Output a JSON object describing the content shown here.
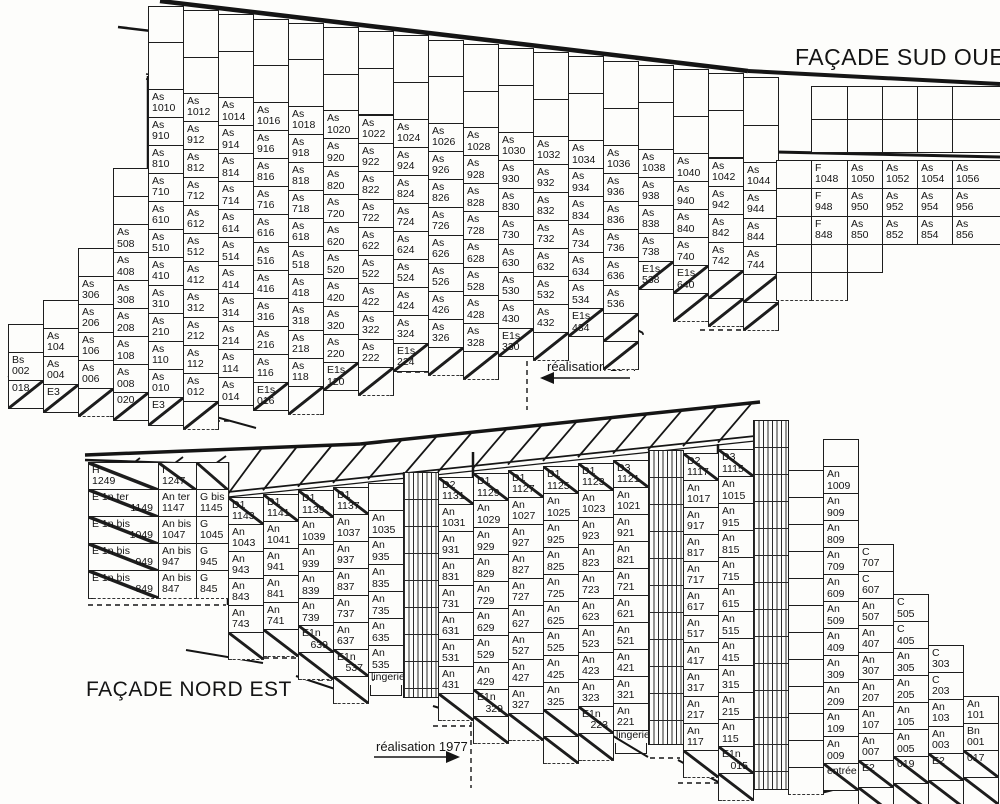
{
  "titles": {
    "sw": "FAÇADE SUD OUEST",
    "ne": "FAÇADE NORD EST"
  },
  "annotations": {
    "realisation": "réalisation 1977"
  },
  "sw_facade": {
    "columns": [
      {
        "id": "02",
        "f": 0,
        "cells": [
          "Bs 002",
          "/018"
        ]
      },
      {
        "id": "04",
        "f": 1,
        "cells": [
          "As 104",
          "As 004",
          "/E3"
        ]
      },
      {
        "id": "06",
        "f": 3,
        "cells": [
          "As 306",
          "As 206",
          "As 106",
          "As 006",
          "/"
        ]
      },
      {
        "id": "08",
        "f": 5,
        "cells": [
          "As 508",
          "As 408",
          "As 308",
          "As 208",
          "As 108",
          "As 008",
          "/020"
        ]
      },
      {
        "id": "10",
        "f": 10,
        "cells": [
          "As 1010",
          "As 910",
          "As 810",
          "As 710",
          "As 610",
          "As 510",
          "As 410",
          "As 310",
          "As 210",
          "As 110",
          "As 010",
          "/E3"
        ]
      },
      {
        "id": "12",
        "f": 10,
        "cells": [
          "As 1012",
          "As 912",
          "As 812",
          "As 712",
          "As 612",
          "As 512",
          "As 412",
          "As 312",
          "As 212",
          "As 112",
          "As 012",
          "/"
        ]
      },
      {
        "id": "14",
        "f": 10,
        "cells": [
          "As 1014",
          "As 914",
          "As 814",
          "As 714",
          "As 614",
          "As 514",
          "As 414",
          "As 314",
          "As 214",
          "As 114",
          "As 014"
        ]
      },
      {
        "id": "16",
        "f": 10,
        "cells": [
          "As 1016",
          "As 916",
          "As 816",
          "As 716",
          "As 616",
          "As 516",
          "As 416",
          "As 316",
          "As 216",
          "As 116",
          "/E1s 016"
        ]
      },
      {
        "id": "18",
        "f": 10,
        "cells": [
          "As 1018",
          "As 918",
          "As 818",
          "As 718",
          "As 618",
          "As 518",
          "As 418",
          "As 318",
          "As 218",
          "As 118",
          "/"
        ]
      },
      {
        "id": "20",
        "f": 10,
        "cells": [
          "As 1020",
          "As 920",
          "As 820",
          "As 720",
          "As 620",
          "As 520",
          "As 420",
          "As 320",
          "As 220",
          "/E1s 120"
        ]
      },
      {
        "id": "22",
        "f": 10,
        "cells": [
          "As 1022",
          "As 922",
          "As 822",
          "As 722",
          "As 622",
          "As 522",
          "As 422",
          "As 322",
          "As 222",
          "/"
        ]
      },
      {
        "id": "24",
        "f": 10,
        "cells": [
          "As 1024",
          "As 924",
          "As 824",
          "As 724",
          "As 624",
          "As 524",
          "As 424",
          "As 324",
          "/E1s 224"
        ]
      },
      {
        "id": "26",
        "f": 10,
        "cells": [
          "As 1026",
          "As 926",
          "As 826",
          "As 726",
          "As 626",
          "As 526",
          "As 426",
          "As 326",
          "/"
        ]
      },
      {
        "id": "28",
        "f": 10,
        "cells": [
          "As 1028",
          "As 928",
          "As 828",
          "As 728",
          "As 628",
          "As 528",
          "As 428",
          "As 328",
          "/"
        ]
      },
      {
        "id": "30",
        "f": 10,
        "cells": [
          "As 1030",
          "As 930",
          "As 830",
          "As 730",
          "As 630",
          "As 530",
          "As 430",
          "/E1s 330"
        ]
      },
      {
        "id": "32",
        "f": 10,
        "cells": [
          "As 1032",
          "As 932",
          "As 832",
          "As 732",
          "As 632",
          "As 532",
          "As 432",
          "/"
        ]
      },
      {
        "id": "34",
        "f": 10,
        "cells": [
          "As 1034",
          "As 934",
          "As 834",
          "As 734",
          "As 634",
          "As 534",
          "/E1s 434"
        ]
      },
      {
        "id": "36",
        "f": 10,
        "cells": [
          "As 1036",
          "As 936",
          "As 836",
          "As 736",
          "As 636",
          "As 536",
          "/",
          "/"
        ]
      },
      {
        "id": "38",
        "f": 10,
        "cells": [
          "As 1038",
          "As 938",
          "As 838",
          "As 738",
          "/E1s 538"
        ]
      },
      {
        "id": "40",
        "f": 10,
        "cells": [
          "As 1040",
          "As 940",
          "As 840",
          "As 740",
          "/E1s 640",
          "/"
        ]
      },
      {
        "id": "42",
        "f": 10,
        "cells": [
          "As 1042",
          "As 942",
          "As 842",
          "As 742",
          "/",
          "/"
        ]
      },
      {
        "id": "44",
        "f": 10,
        "cells": [
          "As 1044",
          "As 944",
          "As 844",
          "As 744",
          "/",
          "/"
        ]
      }
    ],
    "f_block": {
      "rows": [
        [
          "",
          "F 1048",
          "As 1050",
          "As 1052",
          "As 1054",
          "As 1056"
        ],
        [
          "",
          "F 948",
          "As 950",
          "As 952",
          "As 954",
          "As 956"
        ],
        [
          "",
          "F 848",
          "As 850",
          "As 852",
          "As 854",
          "As 856"
        ]
      ]
    }
  },
  "ne_facade": {
    "left_block": {
      "rows": [
        [
          "/H 1249",
          "/I 1247",
          "/"
        ],
        [
          "/E 1n ter 1149",
          "An ter 1147",
          "G bis 1145"
        ],
        [
          "/E 1n bis 1049",
          "An bis 1047",
          "G 1045"
        ],
        [
          "/E 1n bis 949",
          "An bis 947",
          "G 945"
        ],
        [
          "/E 1n bis 849",
          "An bis 847",
          "G 845"
        ]
      ]
    },
    "columns": [
      {
        "id": "43",
        "f": 11,
        "cells": [
          "/D1 1143",
          "An 1043",
          "An 943",
          "An 843",
          "An 743",
          "/"
        ]
      },
      {
        "id": "41",
        "f": 11,
        "cells": [
          "/D1 1141",
          "An 1041",
          "An 941",
          "An 841",
          "An 741",
          "/"
        ]
      },
      {
        "id": "39",
        "f": 11,
        "cells": [
          "/D1 1139",
          "An 1039",
          "An 939",
          "An 839",
          "An 739",
          "/E1n 639",
          "/"
        ]
      },
      {
        "id": "37",
        "f": 11,
        "cells": [
          "/D1 1137",
          "An 1037",
          "An 937",
          "An 837",
          "An 737",
          "An 637",
          "/E1n 537",
          "/"
        ]
      },
      {
        "id": "35",
        "f": 11,
        "cells": [
          "",
          "An 1035",
          "An 935",
          "An 835",
          "An 735",
          "An 635",
          "An 535",
          "@lingerie"
        ]
      },
      {
        "id": "33",
        "hatch": true,
        "top": 472,
        "bottom": 698
      },
      {
        "id": "31",
        "f": 11,
        "cells": [
          "/D2 1131",
          "An 1031",
          "An 931",
          "An 831",
          "An 731",
          "An 631",
          "An 531",
          "An 431",
          "/"
        ]
      },
      {
        "id": "29",
        "f": 11,
        "cells": [
          "/D1 1129",
          "An 1029",
          "An 929",
          "An 829",
          "An 729",
          "An 629",
          "An 529",
          "An 429",
          "/E1n 329",
          "/"
        ]
      },
      {
        "id": "27",
        "f": 11,
        "cells": [
          "/D1 1127",
          "An 1027",
          "An 927",
          "An 827",
          "An 727",
          "An 627",
          "An 527",
          "An 427",
          "An 327",
          "/"
        ]
      },
      {
        "id": "25",
        "f": 11,
        "cells": [
          "/D1 1125",
          "An 1025",
          "An 925",
          "An 825",
          "An 725",
          "An 625",
          "An 525",
          "An 425",
          "An 325",
          "/",
          "/"
        ]
      },
      {
        "id": "23",
        "f": 11,
        "cells": [
          "/D1 1123",
          "An 1023",
          "An 923",
          "An 823",
          "An 723",
          "An 623",
          "An 523",
          "An 423",
          "An 323",
          "/E1n 223",
          "/"
        ]
      },
      {
        "id": "21",
        "f": 11,
        "cells": [
          "/D3 1121",
          "An 1021",
          "An 921",
          "An 821",
          "An 721",
          "An 621",
          "An 521",
          "An 421",
          "An 321",
          "An 221",
          "@lingerie"
        ]
      },
      {
        "id": "19",
        "hatch": true,
        "top": 450,
        "bottom": 745
      },
      {
        "id": "17",
        "f": 11,
        "cells": [
          "/D2 1117",
          "An 1017",
          "An 917",
          "An 817",
          "An 717",
          "An 617",
          "An 517",
          "An 417",
          "An 317",
          "An 217",
          "An 117",
          "/"
        ]
      },
      {
        "id": "15",
        "f": 11,
        "cells": [
          "/D3 1115",
          "An 1015",
          "An 915",
          "An 815",
          "An 715",
          "An 615",
          "An 515",
          "An 415",
          "An 315",
          "An 215",
          "An 115",
          "/E1n 015",
          "/"
        ]
      },
      {
        "id": "13",
        "hatch": true,
        "top": 420,
        "bottom": 790
      },
      {
        "id": "11",
        "f": 10,
        "cells": [
          "",
          "",
          "",
          "",
          "",
          "",
          "",
          "",
          "",
          "",
          "",
          ""
        ]
      },
      {
        "id": "09",
        "f": 11,
        "cells": [
          "",
          "An 1009",
          "An 909",
          "An 809",
          "An 709",
          "An 609",
          "An 509",
          "An 409",
          "An 309",
          "An 209",
          "An 109",
          "An 009",
          "/entrée"
        ]
      },
      {
        "id": "07",
        "f": 7,
        "cells": [
          "C 707",
          "C 607",
          "An 507",
          "An 407",
          "An 307",
          "An 207",
          "An 107",
          "An 007",
          "/E2",
          "/"
        ]
      },
      {
        "id": "05",
        "f": 5,
        "cells": [
          "C 505",
          "C 405",
          "An 305",
          "An 205",
          "An 105",
          "An 005",
          "/019",
          "/"
        ]
      },
      {
        "id": "03",
        "f": 3,
        "cells": [
          "C 303",
          "C 203",
          "An 103",
          "An 003",
          "/E2",
          "/"
        ]
      },
      {
        "id": "01",
        "f": 1,
        "cells": [
          "An 101",
          "Bn 001",
          "/017",
          "/"
        ]
      }
    ]
  }
}
